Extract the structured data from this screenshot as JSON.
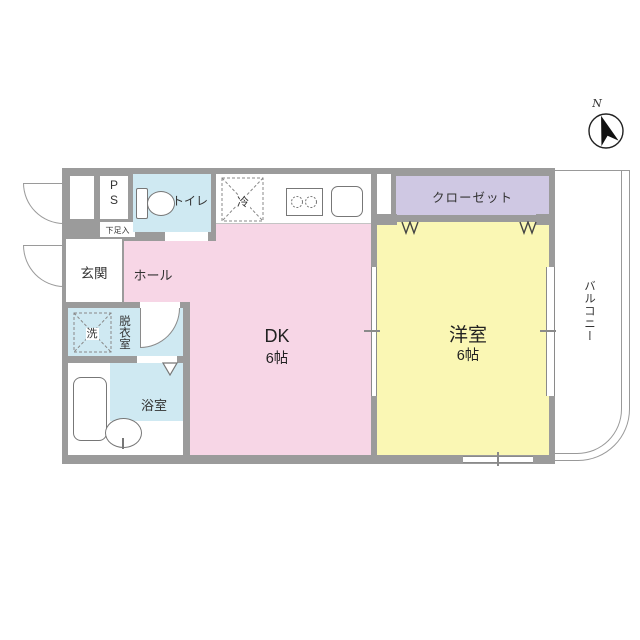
{
  "type": "floor_plan",
  "colors": {
    "wall": "#9b9b9b",
    "dk": "#f7d6e6",
    "western": "#faf7b4",
    "wet": "#cfe9f2",
    "closet": "#cfc8e3"
  },
  "rooms": {
    "dk": {
      "label": "DK",
      "size": "6帖"
    },
    "western": {
      "label": "洋室",
      "size": "6帖"
    },
    "closet": {
      "label": "クローゼット"
    },
    "toilet": {
      "label": "トイレ"
    },
    "entrance": {
      "label": "玄関"
    },
    "hall": {
      "label": "ホール"
    },
    "dressing": {
      "label": "脱衣室"
    },
    "bath": {
      "label": "浴室"
    },
    "balcony": {
      "label": "バルコニー"
    }
  },
  "fixtures": {
    "ps": {
      "label": "PS"
    },
    "shoe_cabinet": {
      "label": "下足入"
    },
    "refrigerator": {
      "label": "冷"
    },
    "washer": {
      "label": "洗"
    }
  },
  "compass": {
    "north_label": "N"
  }
}
